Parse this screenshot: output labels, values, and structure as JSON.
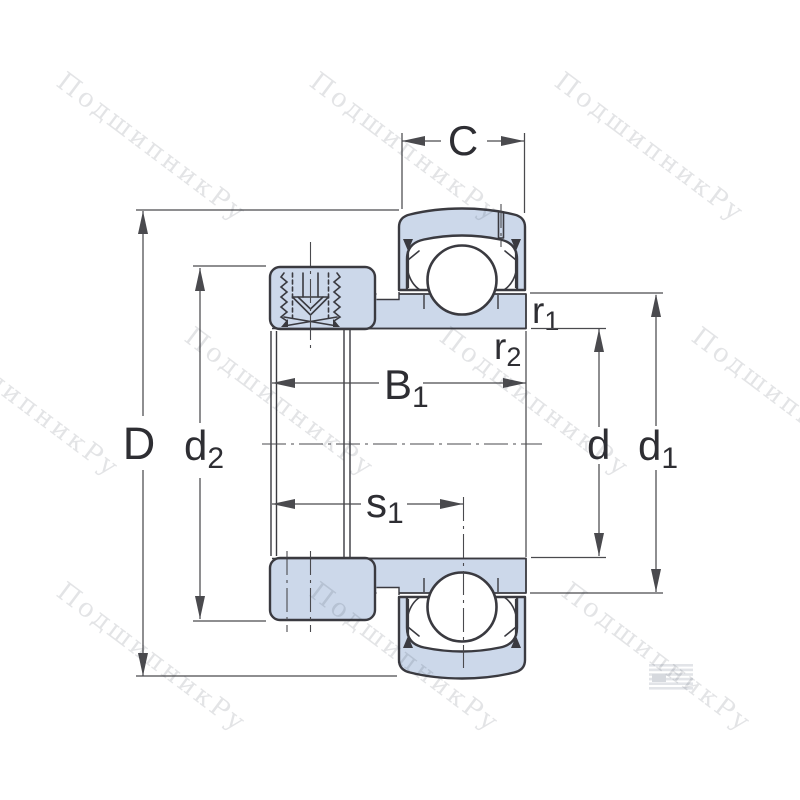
{
  "page": {
    "type": "bearing-cross-section-technical-drawing",
    "description": "Insert ball bearing (Y-bearing) with eccentric locking collar and grub screw, sectional drawing with boundary dimensions"
  },
  "colors": {
    "background": "#ffffff",
    "part_fill": "#ccd8ea",
    "outline": "#3a3a40",
    "dim_color": "#4a4a4e",
    "label_color": "#2e2e33",
    "watermark_color": "rgba(40,45,60,0.13)",
    "logo_color": "#e2e4e8"
  },
  "drawing": {
    "labels": {
      "C": {
        "main": "C"
      },
      "D": {
        "main": "D"
      },
      "d2": {
        "main": "d",
        "sub": "2"
      },
      "B1": {
        "main": "B",
        "sub": "1"
      },
      "s1": {
        "main": "s",
        "sub": "1"
      },
      "r1": {
        "main": "r",
        "sub": "1"
      },
      "r2": {
        "main": "r",
        "sub": "2"
      },
      "d": {
        "main": "d"
      },
      "d1": {
        "main": "d",
        "sub": "1"
      }
    },
    "parts": [
      "outer-ring",
      "ball",
      "seal",
      "inner-ring",
      "locking-collar",
      "grub-screw",
      "relubrication-hole"
    ]
  },
  "watermark": {
    "text": "ПодшипникРу",
    "rotation_deg": 37
  }
}
